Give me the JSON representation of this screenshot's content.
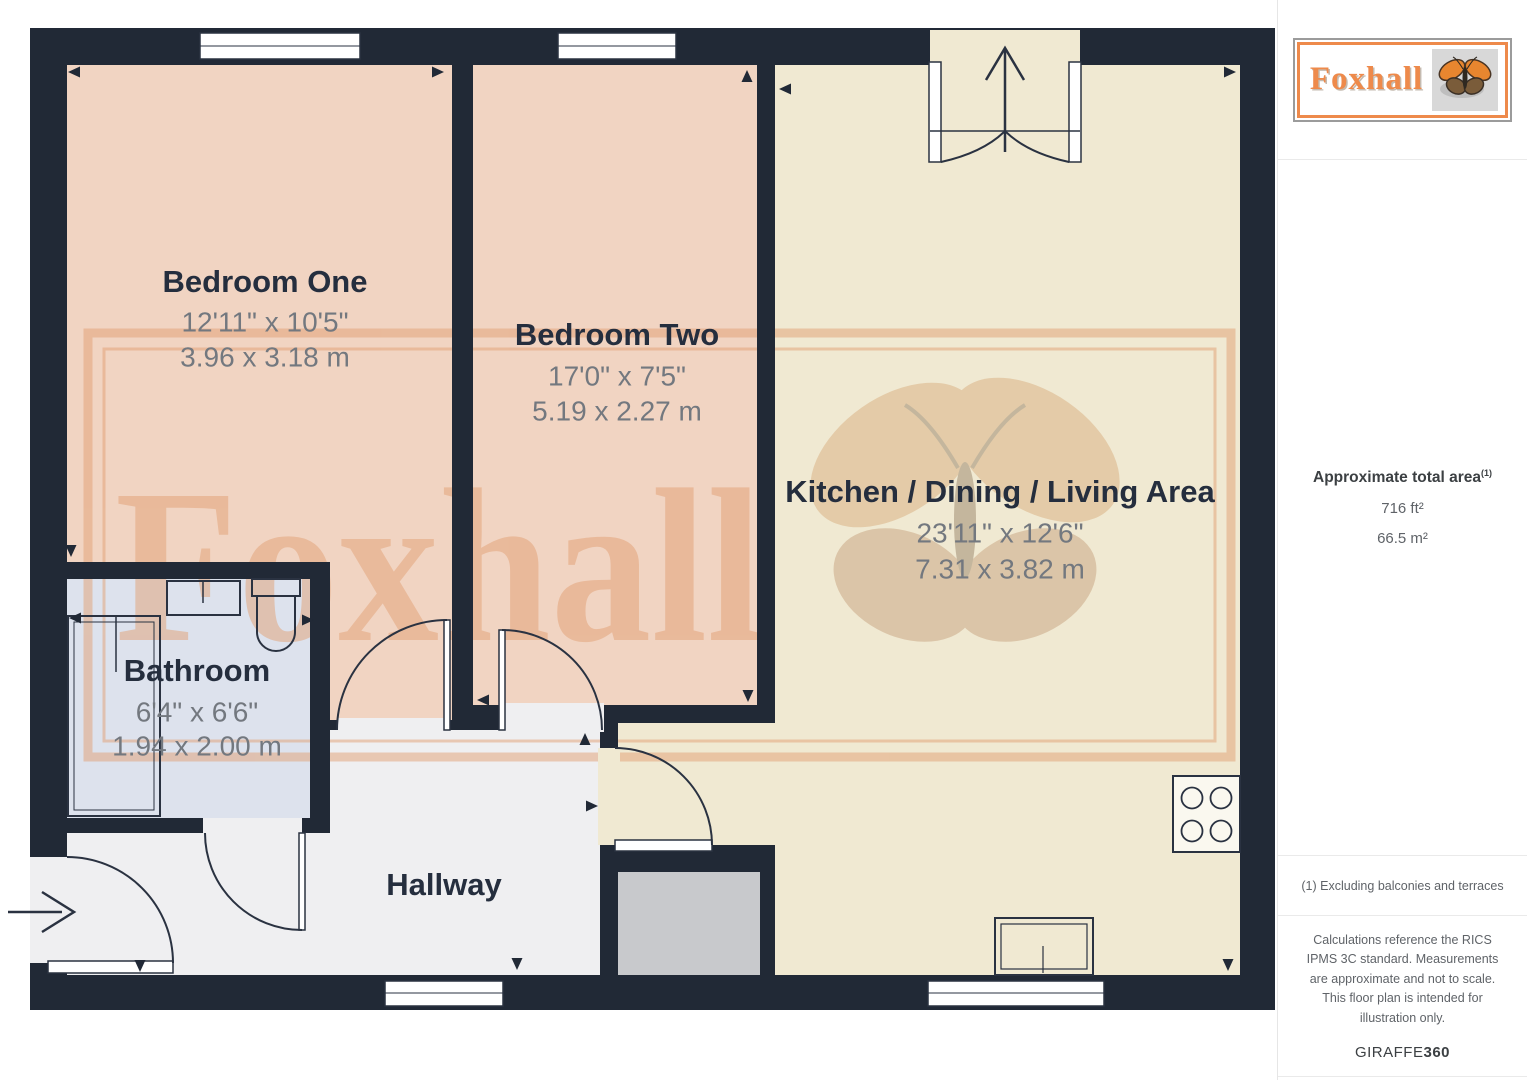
{
  "colors": {
    "wall": "#212936",
    "bedroom": "#f1d4c2",
    "kitchen": "#f0e9d2",
    "bathroom": "#dde2ed",
    "hallway": "#efeff1",
    "storage": "#c8c9cc",
    "line": "#2a3241",
    "label": "#252e3e",
    "dims": "#73787f",
    "accent_orange": "#ee8a4b",
    "watermark": "#e2a074"
  },
  "floorplan": {
    "watermark_text": "Foxhall",
    "rooms": {
      "bedroom_one": {
        "name": "Bedroom One",
        "imperial": "12'11\" x 10'5\"",
        "metric": "3.96 x 3.18 m"
      },
      "bedroom_two": {
        "name": "Bedroom Two",
        "imperial": "17'0\" x 7'5\"",
        "metric": "5.19 x 2.27 m"
      },
      "kitchen": {
        "name": "Kitchen / Dining / Living Area",
        "imperial": "23'11\" x 12'6\"",
        "metric": "7.31 x 3.82 m"
      },
      "bathroom": {
        "name": "Bathroom",
        "imperial": "6'4\" x 6'6\"",
        "metric": "1.94 x 2.00 m"
      },
      "hallway": {
        "name": "Hallway"
      }
    }
  },
  "sidebar": {
    "logo_text": "Foxhall",
    "area": {
      "heading": "Approximate total area",
      "superscript": "(1)",
      "imperial": "716 ft²",
      "metric": "66.5 m²"
    },
    "footnote": "(1) Excluding balconies and terraces",
    "disclaimer": "Calculations reference the RICS IPMS 3C standard. Measurements are approximate and not to scale. This floor plan is intended for illustration only.",
    "brand_regular": "GIRAFFE",
    "brand_bold": "360"
  }
}
